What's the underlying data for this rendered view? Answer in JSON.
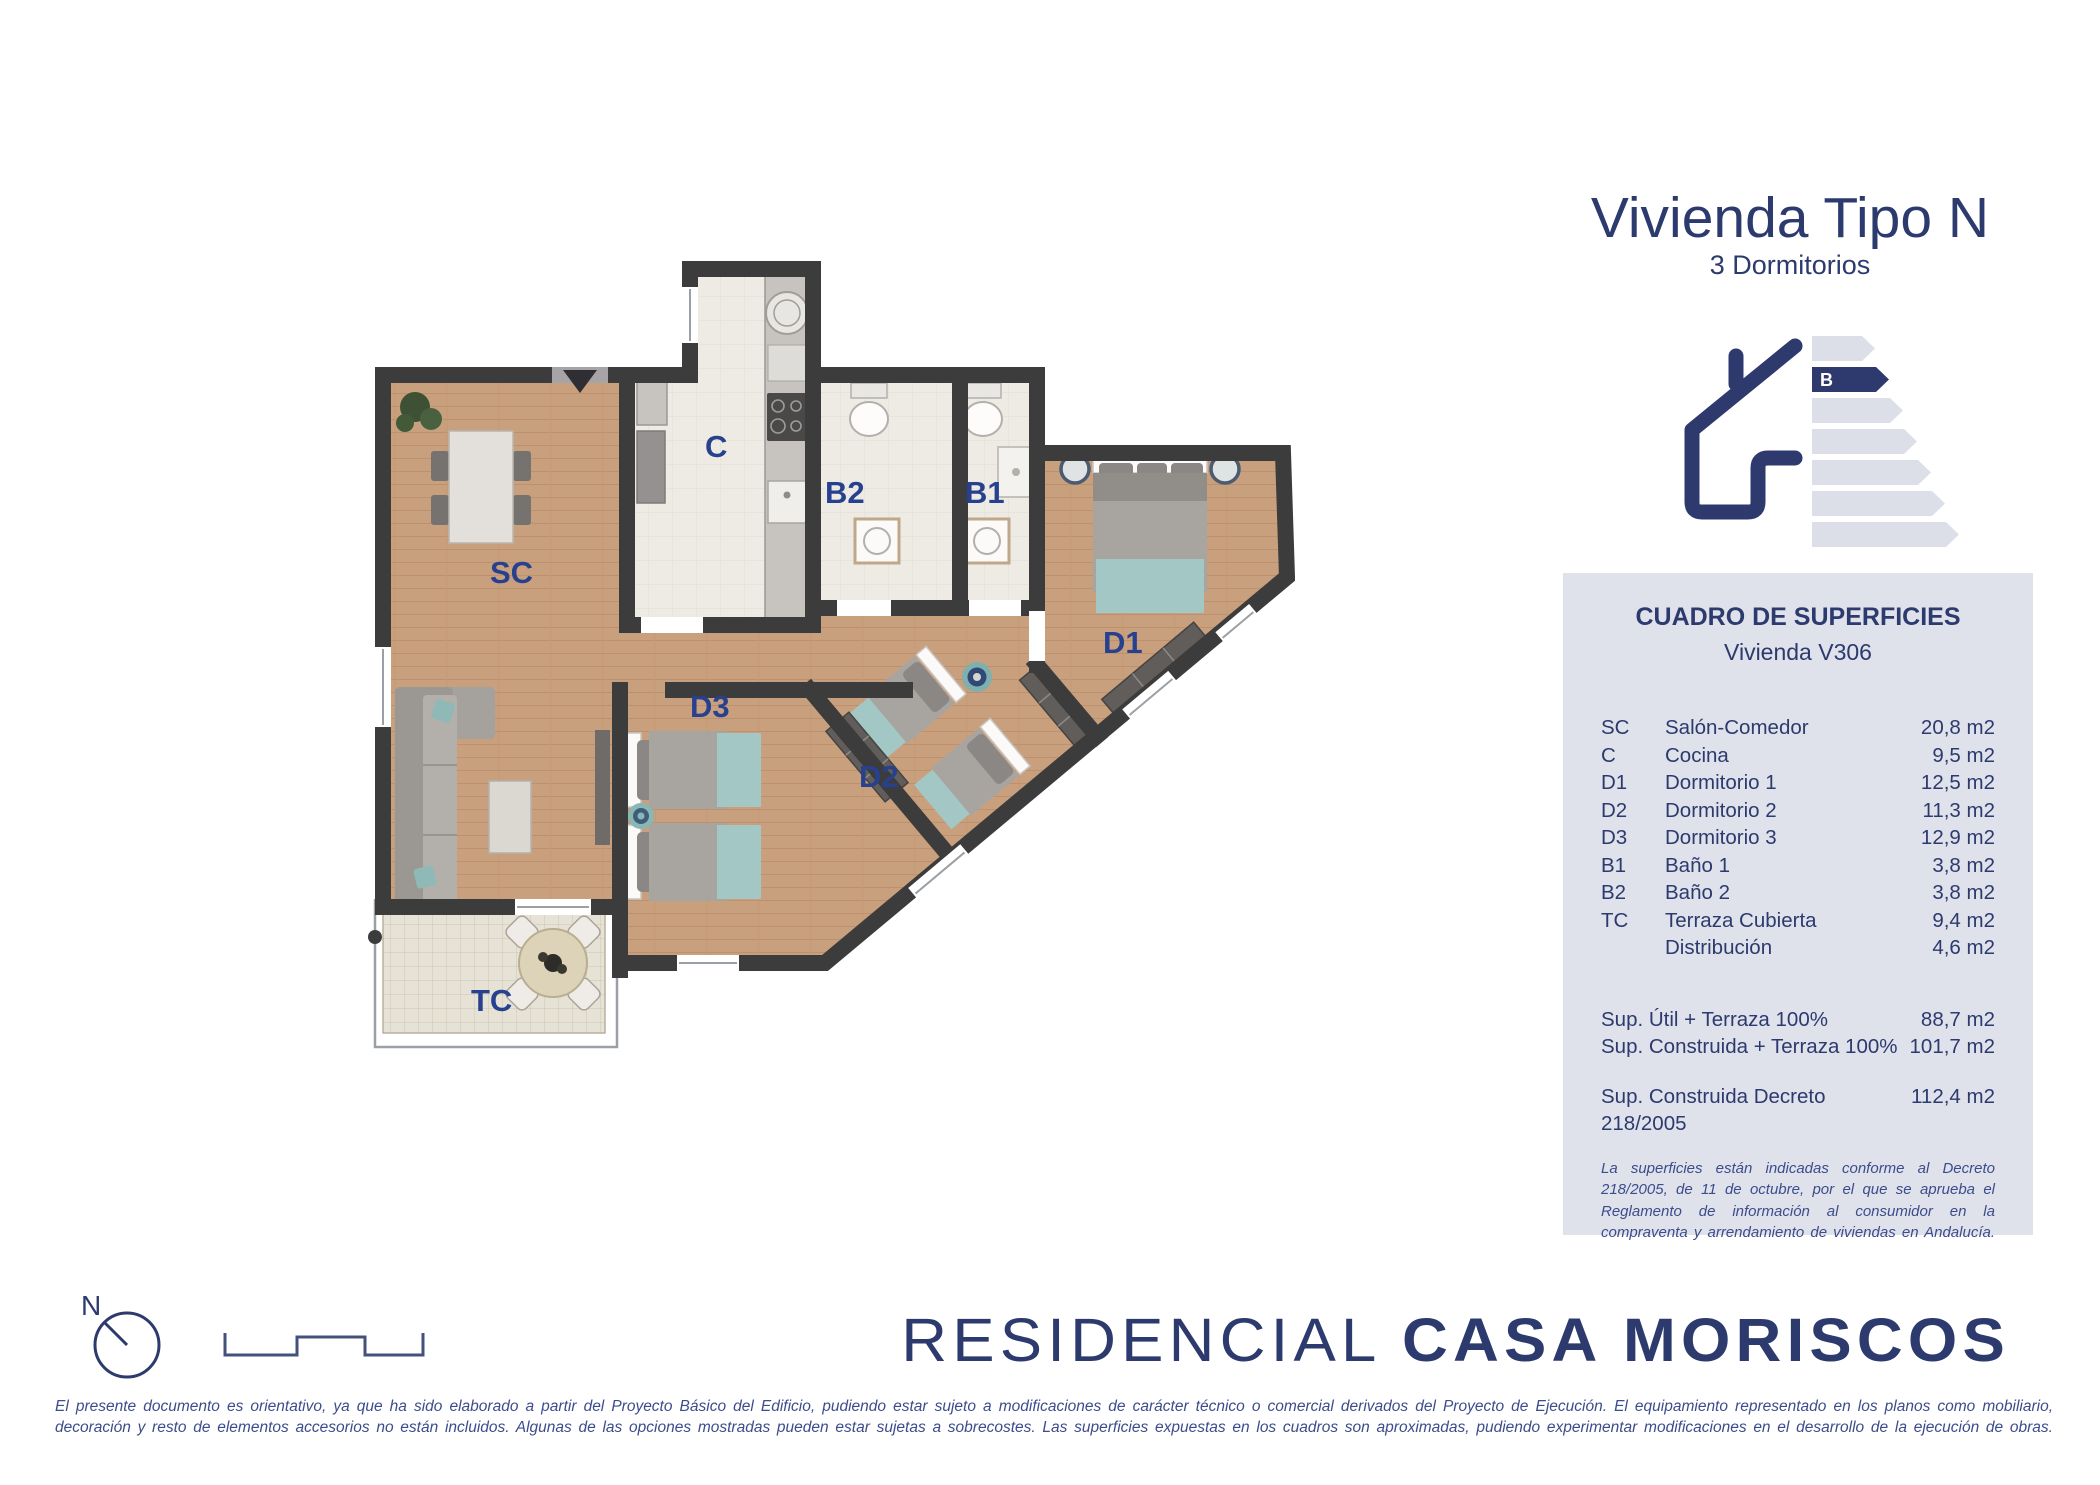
{
  "title": {
    "main": "Vivienda Tipo N",
    "subtitle": "3 Dormitorios"
  },
  "energy": {
    "rating": "B",
    "levels": 7
  },
  "panel": {
    "header": "CUADRO DE SUPERFICIES",
    "subheader": "Vivienda V306",
    "rows": [
      {
        "code": "SC",
        "name": "Salón-Comedor",
        "value": "20,8 m2"
      },
      {
        "code": "C",
        "name": "Cocina",
        "value": "9,5 m2"
      },
      {
        "code": "D1",
        "name": "Dormitorio 1",
        "value": "12,5 m2"
      },
      {
        "code": "D2",
        "name": "Dormitorio 2",
        "value": "11,3 m2"
      },
      {
        "code": "D3",
        "name": "Dormitorio 3",
        "value": "12,9 m2"
      },
      {
        "code": "B1",
        "name": "Baño 1",
        "value": "3,8 m2"
      },
      {
        "code": "B2",
        "name": "Baño 2",
        "value": "3,8 m2"
      },
      {
        "code": "TC",
        "name": "Terraza Cubierta",
        "value": "9,4 m2"
      },
      {
        "code": "",
        "name": "Distribución",
        "value": "4,6 m2"
      }
    ],
    "totals": [
      {
        "name": "Sup. Útil + Terraza 100%",
        "value": "88,7 m2"
      },
      {
        "name": "Sup. Construida + Terraza 100%",
        "value": "101,7 m2"
      }
    ],
    "decree": {
      "name": "Sup. Construida Decreto 218/2005",
      "value": "112,4 m2"
    },
    "note": "La superficies están indicadas conforme al Decreto 218/2005, de 11 de octubre, por el que se aprueba el Reglamento de información al consumidor en la compraventa y arrendamiento de viviendas en Andalucía."
  },
  "plan": {
    "room_labels": {
      "sc": "SC",
      "c": "C",
      "b1": "B1",
      "b2": "B2",
      "d1": "D1",
      "d2": "D2",
      "d3": "D3",
      "tc": "TC"
    },
    "compass_label": "N"
  },
  "brand": {
    "prefix": "RESIDENCIAL ",
    "name": "CASA MORISCOS"
  },
  "disclaimer": {
    "line1": "El presente documento es orientativo, ya que ha sido elaborado a partir del Proyecto Básico del Edificio, pudiendo estar sujeto a modificaciones de carácter técnico o comercial derivados del Proyecto de Ejecución. El equipamiento representado en los planos como mobiliario,",
    "line2": "decoración y resto de elementos accesorios no están incluidos. Algunas de las opciones mostradas pueden estar sujetas a sobrecostes. Las superficies expuestas en los cuadros son aproximadas, pudiendo experimentar modificaciones en el desarrollo de la ejecución de obras."
  },
  "colors": {
    "navy": "#2c3a6e",
    "room_label_blue": "#27418f",
    "panel_bg": "#dfe2ea",
    "wall": "#3d3c3c",
    "wood_floor": "#c9a07e",
    "tile_floor": "#eeebe4",
    "teal_accent": "#a3c7c4",
    "energy_bar_gray": "#dcdfe8"
  }
}
